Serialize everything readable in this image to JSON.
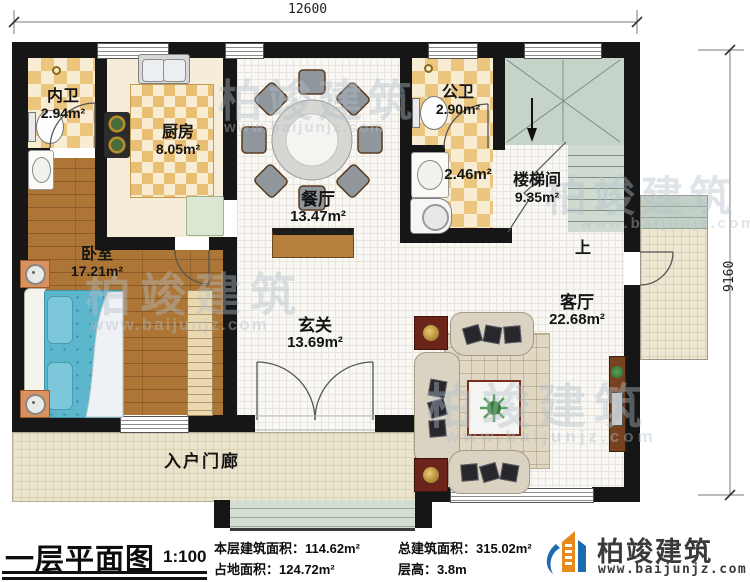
{
  "dimensions": {
    "top": "12600",
    "right": "9160"
  },
  "rooms": {
    "neiwei": {
      "name": "内卫",
      "area": "2.94m²"
    },
    "kitchen": {
      "name": "厨房",
      "area": "8.05m²"
    },
    "dining": {
      "name": "餐厅",
      "area": "13.47m²"
    },
    "gongwei": {
      "name": "公卫",
      "area": "2.90m²"
    },
    "laundry": {
      "area": "2.46m²"
    },
    "stair": {
      "name": "楼梯间",
      "area": "9.35m²",
      "up": "上"
    },
    "bedroom": {
      "name": "卧室",
      "area": "17.21m²"
    },
    "hall": {
      "name": "玄关",
      "area": "13.69m²"
    },
    "living": {
      "name": "客厅",
      "area": "22.68m²"
    },
    "porch": {
      "name": "入户门廊"
    }
  },
  "watermark": {
    "line1": "柏竣建筑",
    "line2": "www.baijunjz.com"
  },
  "footer": {
    "title": "一层平面图",
    "scale": "1:100",
    "stats": [
      {
        "label": "本层建筑面积：",
        "value": "114.62m²"
      },
      {
        "label": "总建筑面积：",
        "value": "315.02m²"
      },
      {
        "label": "占地面积：",
        "value": "124.72m²"
      },
      {
        "label": "层高：",
        "value": "3.8m"
      }
    ],
    "brand": {
      "name": "柏竣建筑",
      "url": "www.baijunjz.com"
    }
  }
}
